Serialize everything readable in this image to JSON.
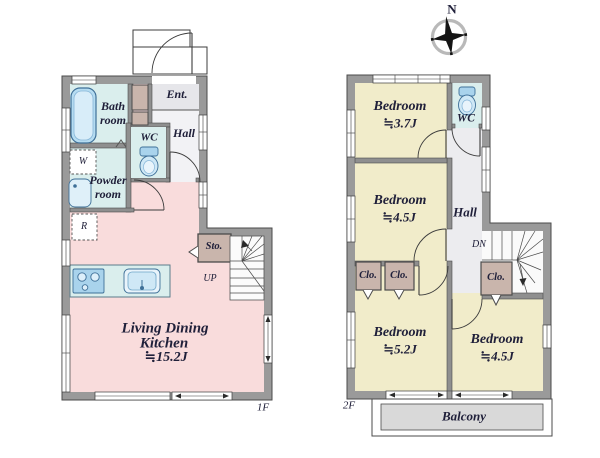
{
  "compass": {
    "north": "N"
  },
  "floor1": {
    "label": "1F",
    "bath": {
      "l1": "Bath",
      "l2": "room"
    },
    "entrance": "Ent.",
    "hall": "Hall",
    "wc": "WC",
    "washer": "W",
    "powder": {
      "l1": "Powder",
      "l2": "room"
    },
    "fridge": "R",
    "storage": "Sto.",
    "up": "UP",
    "ldk": {
      "l1": "Living Dining",
      "l2": "Kitchen",
      "size": "≒15.2J"
    }
  },
  "floor2": {
    "label": "2F",
    "bedroom1": {
      "name": "Bedroom",
      "size": "≒3.7J"
    },
    "wc": "WC",
    "bedroom2": {
      "name": "Bedroom",
      "size": "≒4.5J"
    },
    "hall": "Hall",
    "down": "DN",
    "closet1": "Clo.",
    "closet2": "Clo.",
    "closet3": "Clo.",
    "bedroom3": {
      "name": "Bedroom",
      "size": "≒5.2J"
    },
    "bedroom4": {
      "name": "Bedroom",
      "size": "≒4.5J"
    },
    "balcony": "Balcony"
  },
  "palette": {
    "wall_gray": "#9a9a9a",
    "ldk_pink": "#f9dcdc",
    "wet_area_cyan": "#daeeed",
    "bedroom_cream": "#f1ecca",
    "closet_brown": "#c9b5ac",
    "hall_gray": "#ececef",
    "balcony_gray": "#d9d9d9",
    "fixture_blue": "#a9d3ec"
  }
}
